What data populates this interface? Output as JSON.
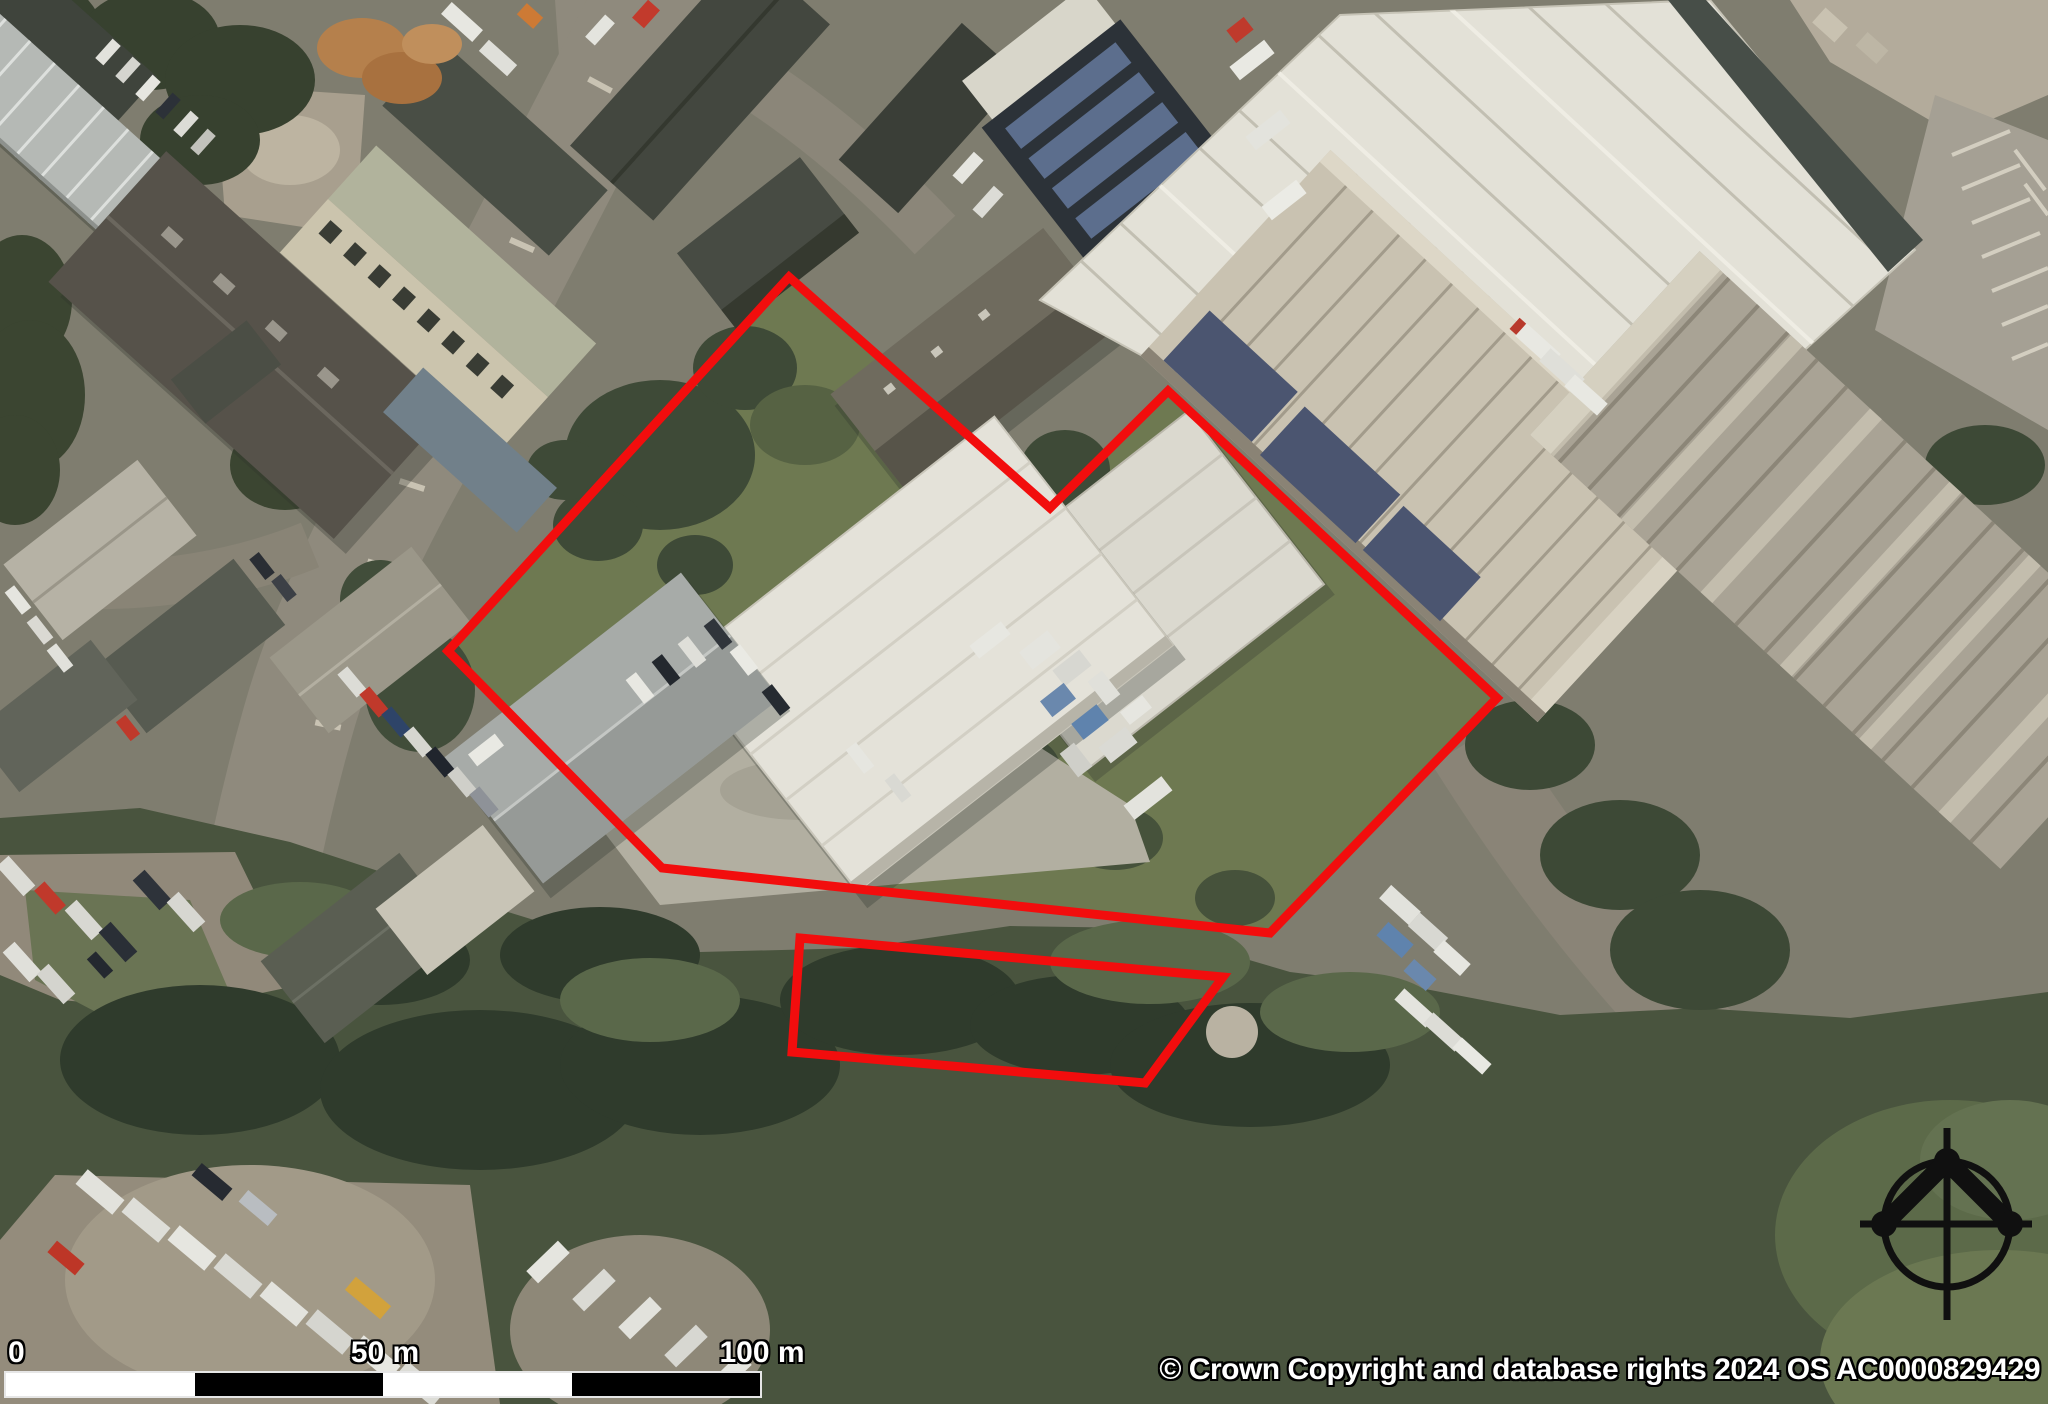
{
  "map": {
    "kind": "aerial-imagery-site-plan",
    "attribution": "© Crown Copyright and database rights 2024 OS AC0000829429",
    "scale_bar": {
      "start_label": "0",
      "mid_label": "50 m",
      "end_label": "100 m",
      "segment_length_m": 25,
      "total_length_m": 100,
      "segment_colors": [
        "#ffffff",
        "#000000",
        "#ffffff",
        "#000000"
      ]
    },
    "site_boundary": {
      "color": "#f20d0d",
      "stroke_width_px": 9,
      "main_polygon_points": "789,277 1050,508 1168,391 1497,698 1270,933 662,868 448,651",
      "detached_polygon_points": "800,938 1223,977 1145,1083 792,1052"
    },
    "north_arrow_color": "#101010"
  }
}
